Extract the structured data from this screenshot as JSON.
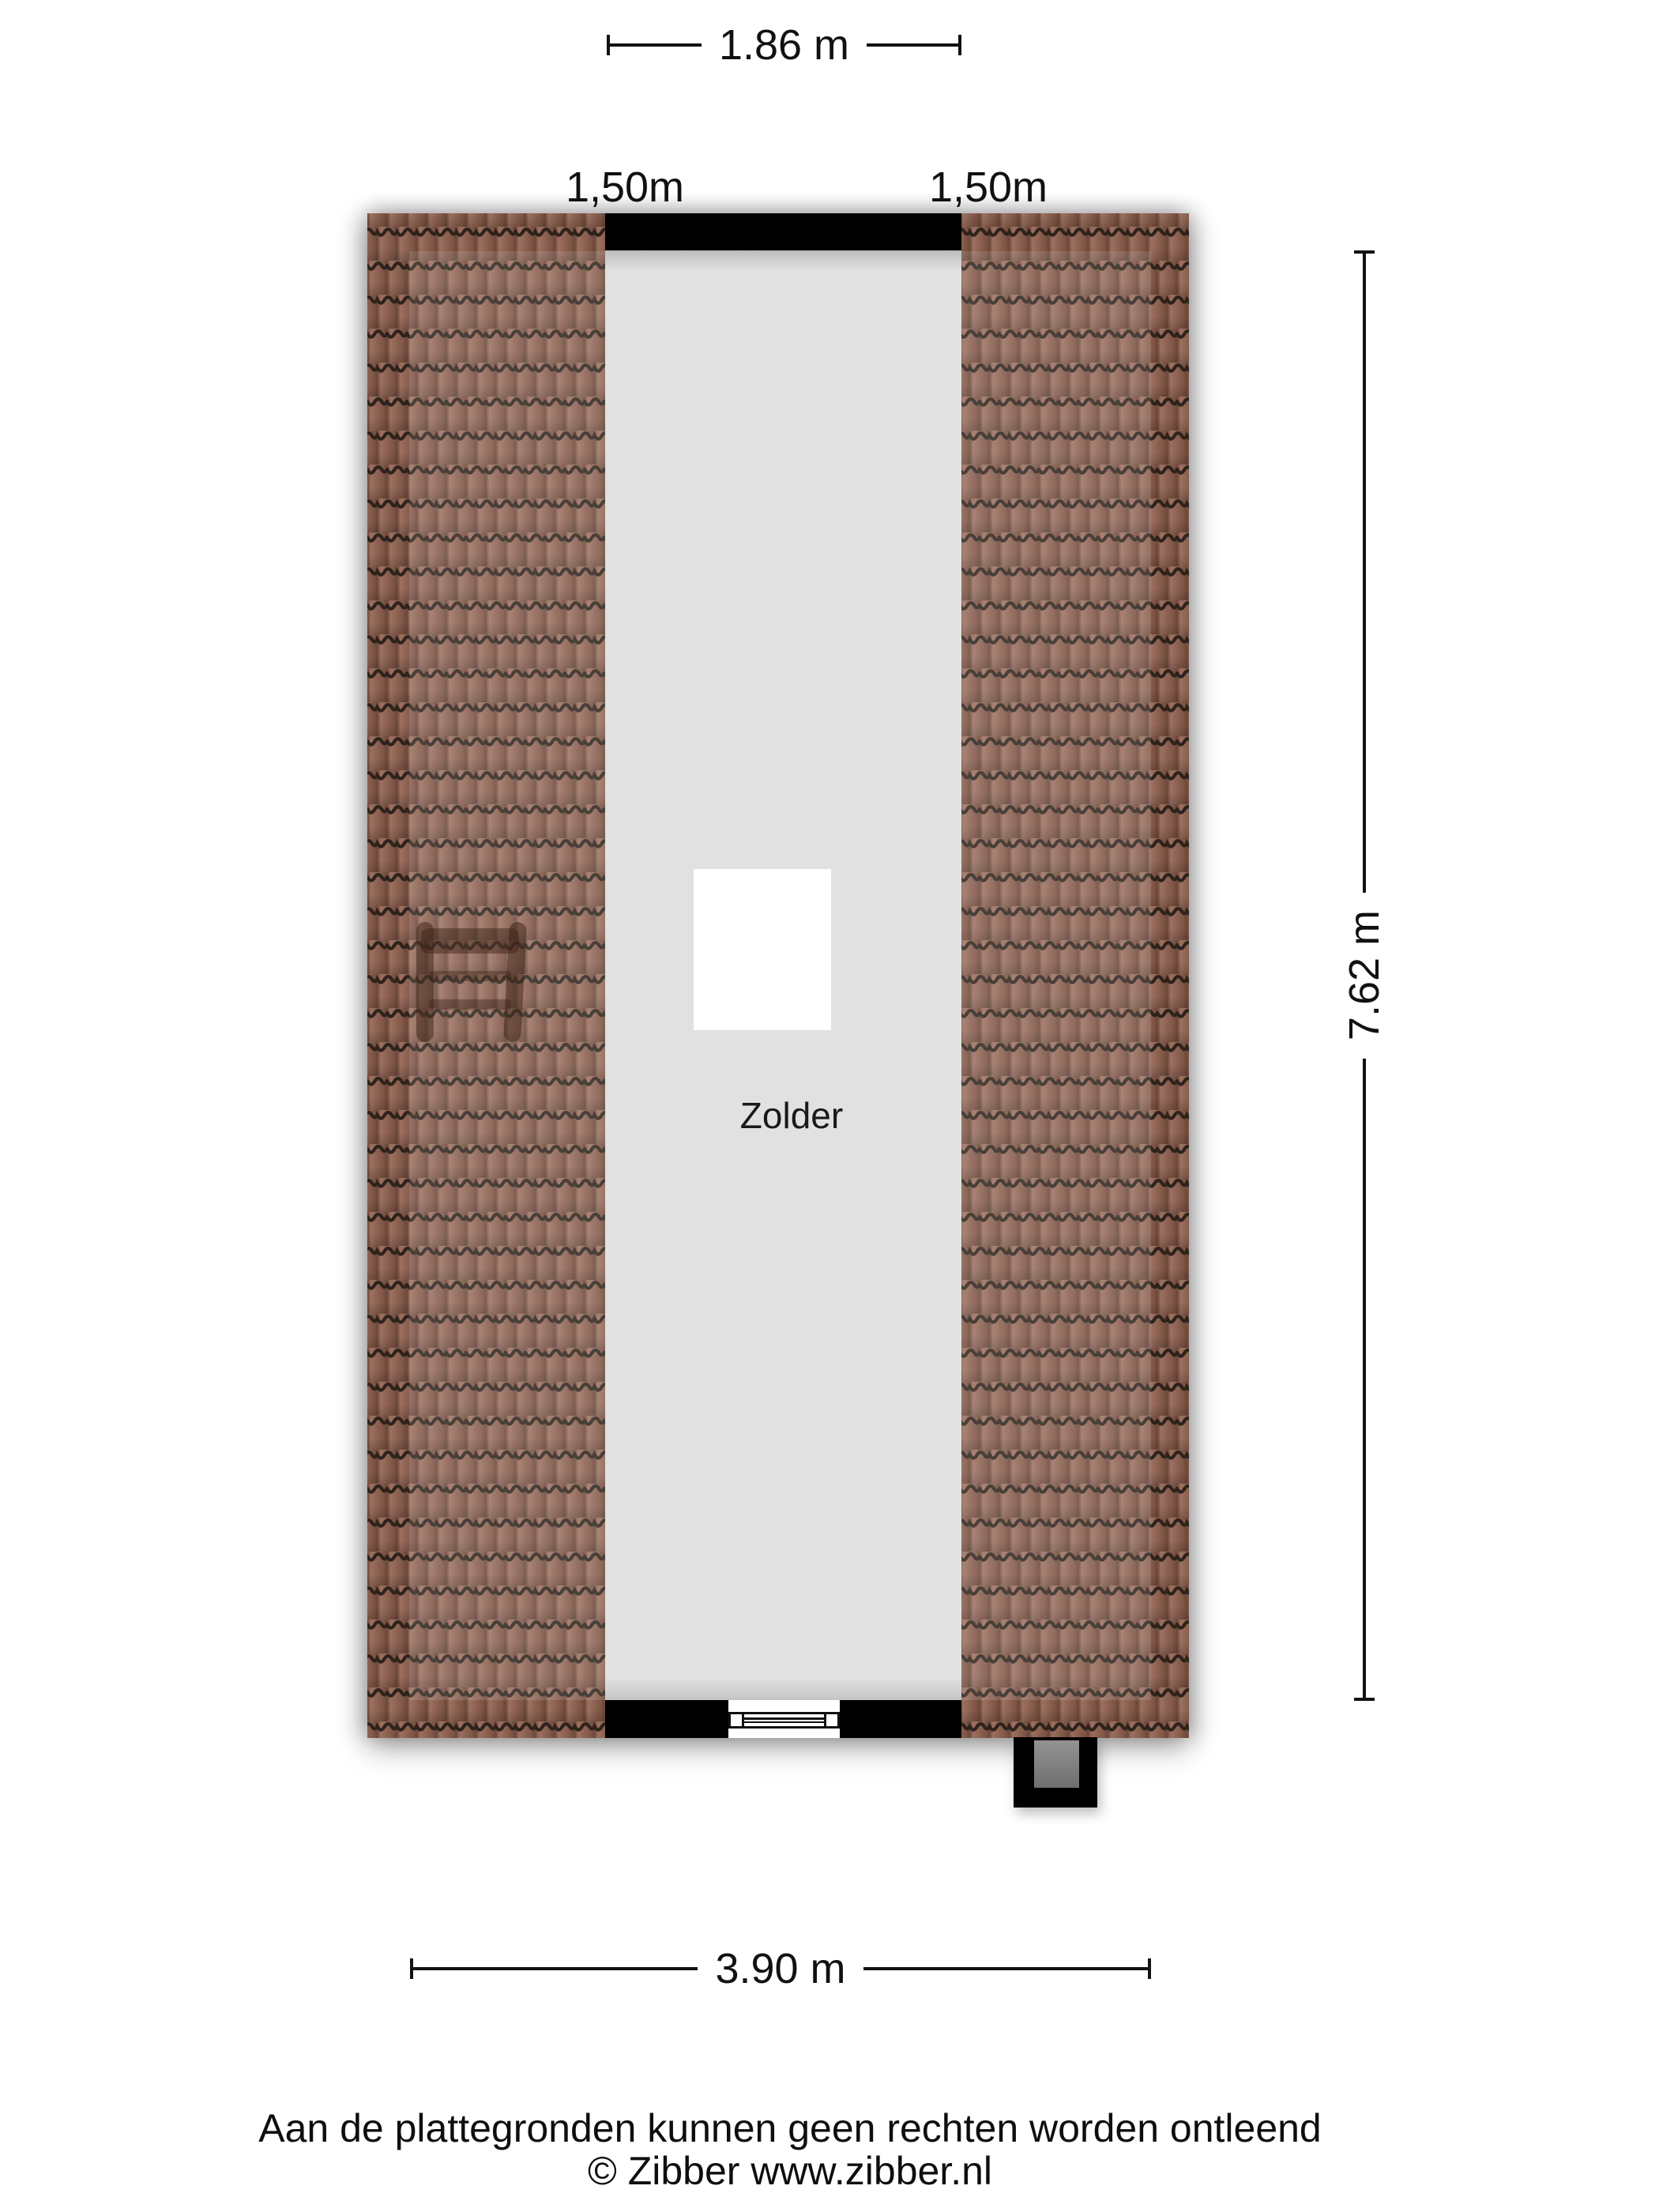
{
  "plan": {
    "room": {
      "label": "Zolder"
    },
    "dimensions": {
      "top_width": "1.86 m",
      "roof_left": "1,50m",
      "roof_right": "1,50m",
      "height": "7.62 m",
      "bottom_width": "3.90 m"
    }
  },
  "footer": {
    "disclaimer": "Aan de plattegronden kunnen geen rechten worden ontleend",
    "copyright": "© Zibber www.zibber.nl"
  },
  "colors": {
    "wall": "#000000",
    "floor": "#e1e1e1",
    "roof_tile": "#8d6251",
    "roof_tile_line": "#2e231c",
    "chimney_inner": "#7f7f7f",
    "background": "#ffffff",
    "text": "#111111"
  }
}
